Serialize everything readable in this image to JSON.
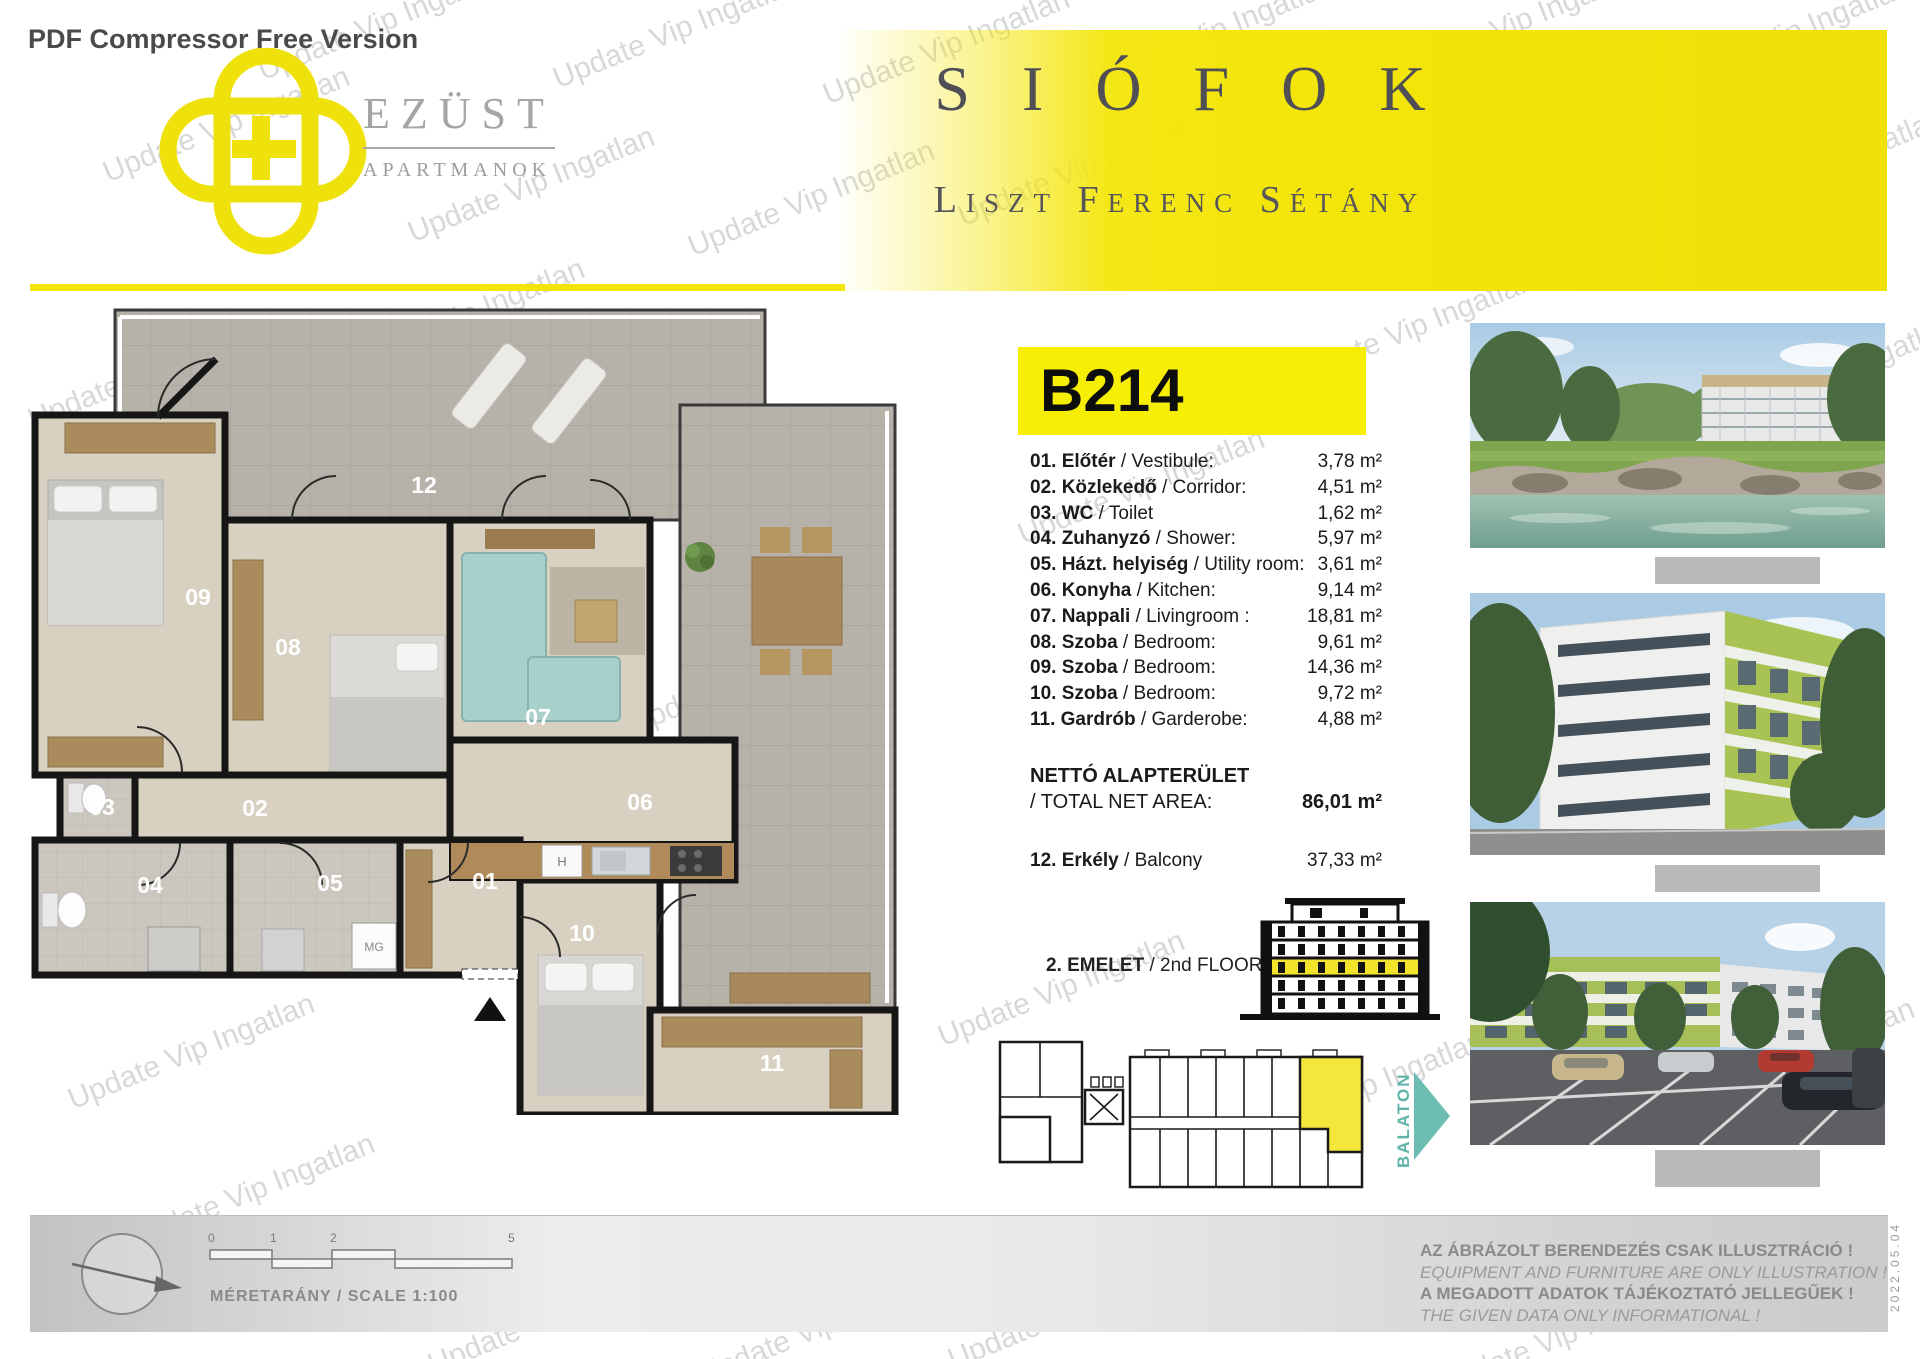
{
  "banner": {
    "pdf_label": "PDF Compressor Free Version"
  },
  "watermark": {
    "text": "Update Vip Ingatlan"
  },
  "brand": {
    "name": "EZÜST",
    "subtitle": "APARTMANOK"
  },
  "header": {
    "city": "SIÓFOK",
    "street": "Liszt Ferenc Sétány"
  },
  "unit": {
    "code": "B214"
  },
  "room_list": {
    "rows": [
      {
        "hu": "01. Előtér",
        "en": " / Vestibule:",
        "area": "3,78 m²"
      },
      {
        "hu": "02. Közlekedő",
        "en": " / Corridor:",
        "area": "4,51 m²"
      },
      {
        "hu": "03. WC",
        "en": " / Toilet",
        "area": "1,62 m²"
      },
      {
        "hu": "04. Zuhanyzó",
        "en": " / Shower:",
        "area": "5,97 m²"
      },
      {
        "hu": "05. Házt. helyiség",
        "en": " / Utility room:",
        "area": "3,61 m²"
      },
      {
        "hu": "06. Konyha",
        "en": " / Kitchen:",
        "area": "9,14 m²"
      },
      {
        "hu": "07. Nappali",
        "en": " / Livingroom :",
        "area": "18,81 m²"
      },
      {
        "hu": "08. Szoba",
        "en": " / Bedroom:",
        "area": "9,61 m²"
      },
      {
        "hu": "09. Szoba",
        "en": " / Bedroom:",
        "area": "14,36 m²"
      },
      {
        "hu": "10. Szoba",
        "en": " / Bedroom:",
        "area": "9,72 m²"
      },
      {
        "hu": "11. Gardrób",
        "en": " / Garderobe:",
        "area": "4,88 m²"
      }
    ],
    "total": {
      "hu": "NETTÓ ALAPTERÜLET",
      "en": " / TOTAL NET AREA:",
      "area": "86,01 m²"
    },
    "balcony": {
      "hu": "12. Erkély",
      "en": " / Balcony",
      "area": "37,33 m²"
    }
  },
  "floor_indicator": {
    "hu": "2. EMELET",
    "en": " / 2nd FLOOR"
  },
  "site": {
    "direction_label": "BALATON"
  },
  "plan": {
    "labels": [
      "12",
      "09",
      "08",
      "07",
      "06",
      "03",
      "02",
      "04",
      "05",
      "01",
      "10",
      "11"
    ],
    "appliances": {
      "washer": "MG",
      "fridge": "H"
    }
  },
  "scalebar": {
    "ticks": [
      "0",
      "1",
      "2",
      "5"
    ],
    "caption": "MÉRETARÁNY / SCALE 1:100"
  },
  "disclaimer": {
    "l1": "AZ ÁBRÁZOLT BERENDEZÉS CSAK ILLUSZTRÁCIÓ !",
    "l2": "EQUIPMENT AND FURNITURE ARE ONLY ILLUSTRATION !",
    "l3": "A MEGADOTT ADATOK TÁJÉKOZTATÓ JELLEGŰEK !",
    "l4": "THE GIVEN DATA ONLY INFORMATIONAL !"
  },
  "side_date": "2022.05.04",
  "colors": {
    "accent_yellow": "#F2E813",
    "teal": "#6BBCB1",
    "title_gray": "#4F4F55"
  }
}
